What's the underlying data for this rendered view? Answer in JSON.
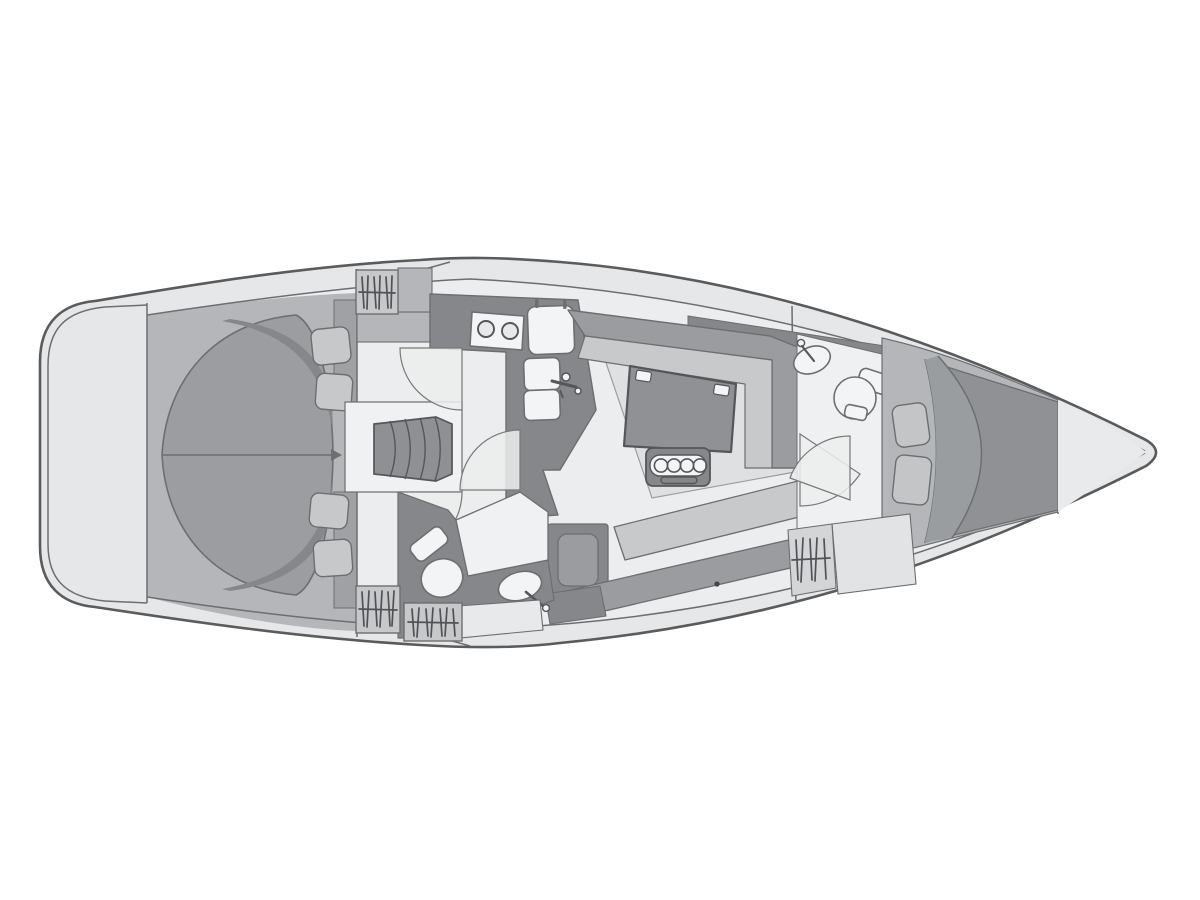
{
  "diagram": {
    "type": "yacht-floor-plan",
    "view": "top-down",
    "orientation": {
      "bow": "right",
      "stern": "left"
    },
    "palette": {
      "background": "#ffffff",
      "hull_fill": "#e6e7e8",
      "hull_stroke": "#5a5b5d",
      "interior_fill": "#ecedee",
      "cabin_floor": "#b4b6b9",
      "counter_dark": "#85878a",
      "furniture_mid": "#9a9ca0",
      "seat_light": "#c7c9cb",
      "bed_aft": "#9b9da0",
      "bed_fwd": "#8f9194",
      "fixture_white": "#f3f4f5",
      "locker_fill": "#c6c8ca",
      "line": "#6d6e70"
    },
    "areas": [
      {
        "id": "stern-deck",
        "label": "stern deck and rounded transom"
      },
      {
        "id": "aft-cabin",
        "label": "aft owner cabin with full-beam island berth and four pillows"
      },
      {
        "id": "companionway",
        "label": "companionway steps and landing"
      },
      {
        "id": "galley",
        "label": "L-shaped galley with two-burner stove, fridge and double sink with faucet"
      },
      {
        "id": "aft-head",
        "label": "aft head compartment with toilet, washbasin and shower pan"
      },
      {
        "id": "saloon",
        "label": "saloon with U-shaped settee, folding table with bottle holder, bench settee and single seat"
      },
      {
        "id": "forward-head",
        "label": "forward head compartment with washbasin and toilet"
      },
      {
        "id": "forward-cabin",
        "label": "forward V-berth cabin with double berth and two pillows"
      },
      {
        "id": "bow-locker",
        "label": "bow anchor locker"
      },
      {
        "id": "lockers",
        "label": "hatched hanging lockers"
      }
    ]
  }
}
